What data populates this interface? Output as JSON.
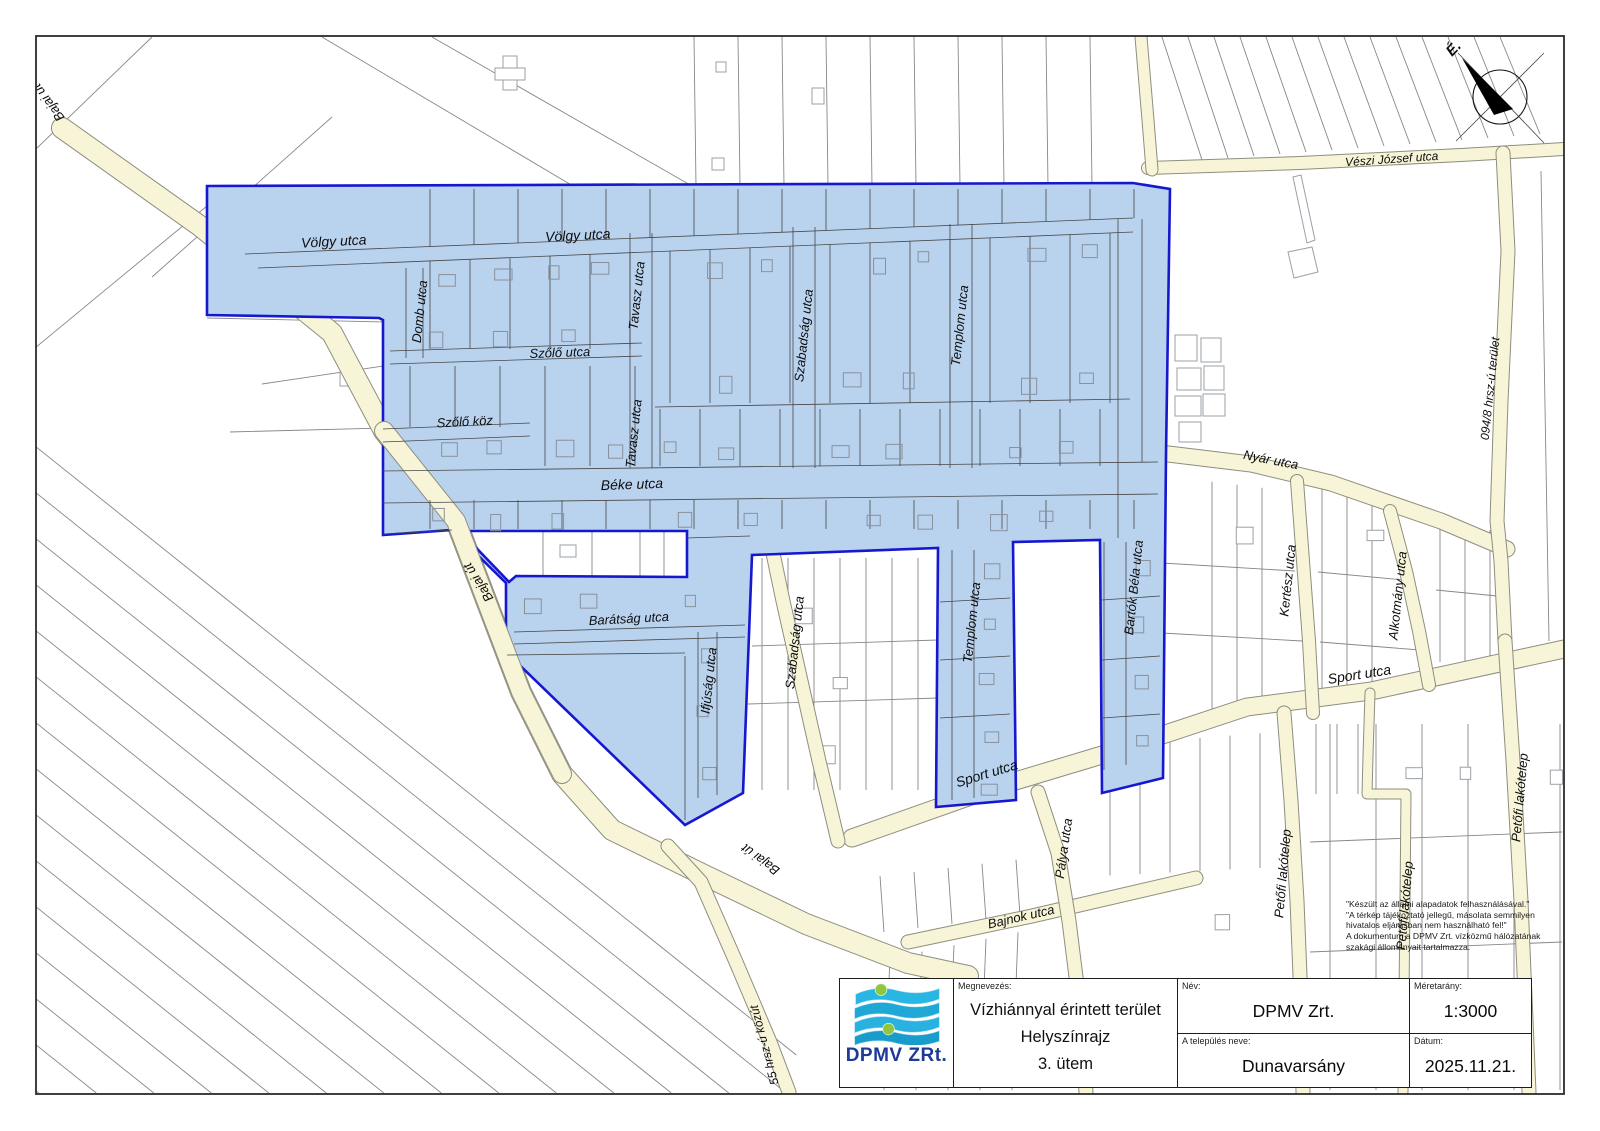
{
  "title_block": {
    "megnevezes_label": "Megnevezés:",
    "megnevezes_lines": [
      "Vízhiánnyal érintett terület",
      "Helyszínrajz",
      "3. ütem"
    ],
    "nev_label": "Név:",
    "nev_value": "DPMV Zrt.",
    "telepules_label": "A település neve:",
    "telepules_value": "Dunavarsány",
    "meretarany_label": "Méretarány:",
    "meretarany_value": "1:3000",
    "datum_label": "Dátum:",
    "datum_value": "2025.11.21.",
    "logo_text": "DPMV ZRt."
  },
  "disclaimer": {
    "lines": [
      "\"Készült az állami alapadatok felhasználásával.\"",
      "\"A térkép tájékoztató jellegű, másolata semmilyen",
      "hivatalos eljárásban nem használható fel!\"",
      "A dokumentum a DPMV Zrt. vízközmű hálózatának",
      "szakági állományait tartalmazza."
    ]
  },
  "compass": {
    "cx": 1500,
    "cy": 97,
    "r": 27,
    "label": "É."
  },
  "map": {
    "colors": {
      "highlight_fill": "#b9d3ef",
      "highlight_stroke": "#1717cf",
      "road_fill": "#f7f4d8",
      "road_edge": "#8e8e7e",
      "parcel_line": "#878787",
      "inner_line": "#474747"
    },
    "highlight_outline": [
      [
        207,
        186
      ],
      [
        1133,
        183
      ],
      [
        1170,
        189
      ],
      [
        1166,
        455
      ],
      [
        1163,
        778
      ],
      [
        1102,
        793
      ],
      [
        1100,
        540
      ],
      [
        1013,
        542
      ],
      [
        1016,
        800
      ],
      [
        936,
        807
      ],
      [
        938,
        548
      ],
      [
        752,
        555
      ],
      [
        743,
        793
      ],
      [
        685,
        825
      ],
      [
        506,
        652
      ],
      [
        506,
        583
      ],
      [
        452,
        530
      ],
      [
        383,
        535
      ],
      [
        383,
        320
      ],
      [
        379,
        318
      ],
      [
        207,
        315
      ]
    ],
    "highlight_hole": [
      [
        460,
        531
      ],
      [
        687,
        531
      ],
      [
        687,
        577
      ],
      [
        516,
        576
      ],
      [
        509,
        582
      ]
    ],
    "roads": [
      {
        "pts": [
          [
            62,
            128
          ],
          [
            200,
            226
          ],
          [
            332,
            333
          ],
          [
            384,
            431
          ],
          [
            456,
            521
          ],
          [
            521,
            692
          ],
          [
            562,
            774
          ],
          [
            612,
            830
          ],
          [
            702,
            874
          ],
          [
            806,
            924
          ],
          [
            908,
            963
          ],
          [
            968,
            976
          ]
        ],
        "w": 20
      },
      {
        "pts": [
          [
            668,
            846
          ],
          [
            701,
            882
          ],
          [
            736,
            962
          ],
          [
            770,
            1042
          ],
          [
            789,
            1092
          ]
        ],
        "w": 13
      },
      {
        "pts": [
          [
            852,
            838
          ],
          [
            1002,
            785
          ],
          [
            1102,
            755
          ],
          [
            1247,
            707
          ],
          [
            1371,
            691
          ],
          [
            1564,
            649
          ]
        ],
        "w": 17
      },
      {
        "pts": [
          [
            908,
            942
          ],
          [
            1032,
            916
          ],
          [
            1196,
            878
          ]
        ],
        "w": 13
      },
      {
        "pts": [
          [
            1038,
            792
          ],
          [
            1058,
            853
          ],
          [
            1069,
            921
          ],
          [
            1079,
            1001
          ],
          [
            1086,
            1092
          ]
        ],
        "w": 13
      },
      {
        "pts": [
          [
            1160,
            453
          ],
          [
            1251,
            464
          ],
          [
            1331,
            483
          ],
          [
            1441,
            521
          ],
          [
            1507,
            549
          ]
        ],
        "w": 15
      },
      {
        "pts": [
          [
            1297,
            481
          ],
          [
            1303,
            561
          ],
          [
            1309,
            641
          ],
          [
            1313,
            713
          ]
        ],
        "w": 12
      },
      {
        "pts": [
          [
            1390,
            511
          ],
          [
            1406,
            571
          ],
          [
            1419,
            631
          ],
          [
            1429,
            685
          ]
        ],
        "w": 12
      },
      {
        "pts": [
          [
            1148,
            168
          ],
          [
            1300,
            163
          ],
          [
            1461,
            155
          ],
          [
            1564,
            149
          ]
        ],
        "w": 12
      },
      {
        "pts": [
          [
            1141,
            37
          ],
          [
            1148,
            120
          ],
          [
            1152,
            170
          ]
        ],
        "w": 11
      },
      {
        "pts": [
          [
            1503,
            153
          ],
          [
            1508,
            251
          ],
          [
            1501,
            401
          ],
          [
            1497,
            521
          ],
          [
            1501,
            561
          ],
          [
            1505,
            641
          ]
        ],
        "w": 13
      },
      {
        "pts": [
          [
            1284,
            713
          ],
          [
            1291,
            801
          ],
          [
            1297,
            901
          ],
          [
            1301,
            1001
          ],
          [
            1303,
            1092
          ]
        ],
        "w": 13
      },
      {
        "pts": [
          [
            1370,
            693
          ],
          [
            1368,
            756
          ],
          [
            1367,
            794
          ],
          [
            1406,
            794
          ],
          [
            1405,
            901
          ],
          [
            1403,
            1092
          ]
        ],
        "w": 9
      },
      {
        "pts": [
          [
            1505,
            641
          ],
          [
            1513,
            761
          ],
          [
            1521,
            901
          ],
          [
            1529,
            1092
          ]
        ],
        "w": 13
      },
      {
        "pts": [
          [
            770,
            539
          ],
          [
            783,
            601
          ],
          [
            801,
            681
          ],
          [
            819,
            761
          ],
          [
            838,
            841
          ]
        ],
        "w": 13
      }
    ],
    "roads_overlay": [
      {
        "pts": [
          [
            384,
            431
          ],
          [
            456,
            521
          ],
          [
            521,
            692
          ],
          [
            562,
            774
          ]
        ],
        "w": 18
      }
    ],
    "inner_lines": [
      [
        245,
        254,
        1133,
        218
      ],
      [
        258,
        268,
        1133,
        232
      ],
      [
        390,
        351,
        642,
        343
      ],
      [
        390,
        364,
        642,
        356
      ],
      [
        383,
        429,
        530,
        423
      ],
      [
        383,
        442,
        530,
        436
      ],
      [
        383,
        471,
        1158,
        462
      ],
      [
        383,
        503,
        1158,
        494
      ],
      [
        406,
        268,
        406,
        358
      ],
      [
        423,
        268,
        423,
        358
      ],
      [
        630,
        233,
        630,
        468
      ],
      [
        652,
        233,
        652,
        468
      ],
      [
        793,
        227,
        793,
        468
      ],
      [
        815,
        227,
        815,
        468
      ],
      [
        950,
        224,
        950,
        468
      ],
      [
        972,
        224,
        972,
        468
      ],
      [
        1118,
        219,
        1118,
        538
      ],
      [
        1142,
        219,
        1142,
        462
      ],
      [
        655,
        407,
        1130,
        399
      ],
      [
        383,
        534,
        452,
        530
      ],
      [
        687,
        538,
        750,
        536
      ],
      [
        514,
        632,
        745,
        625
      ],
      [
        514,
        644,
        745,
        637
      ],
      [
        507,
        655,
        685,
        653
      ],
      [
        685,
        656,
        685,
        820
      ],
      [
        698,
        632,
        698,
        798
      ],
      [
        717,
        632,
        717,
        795
      ],
      [
        952,
        550,
        952,
        800
      ],
      [
        974,
        550,
        974,
        798
      ],
      [
        1104,
        542,
        1104,
        770
      ],
      [
        1126,
        542,
        1126,
        765
      ],
      [
        940,
        602,
        1010,
        598
      ],
      [
        940,
        660,
        1010,
        656
      ],
      [
        940,
        718,
        1010,
        714
      ],
      [
        1102,
        600,
        1160,
        596
      ],
      [
        1102,
        660,
        1160,
        656
      ],
      [
        1102,
        718,
        1160,
        714
      ]
    ],
    "street_labels": [
      {
        "t": "Völgy utca",
        "x": 334,
        "y": 246,
        "r": -3,
        "s": 14
      },
      {
        "t": "Völgy utca",
        "x": 578,
        "y": 240,
        "r": -3,
        "s": 14
      },
      {
        "t": "Domb utca",
        "x": 424,
        "y": 312,
        "r": -84,
        "s": 13
      },
      {
        "t": "Tavasz utca",
        "x": 641,
        "y": 296,
        "r": -84,
        "s": 13
      },
      {
        "t": "Szőlő utca",
        "x": 560,
        "y": 357,
        "r": -2,
        "s": 13
      },
      {
        "t": "Szőlő köz",
        "x": 465,
        "y": 426,
        "r": -3,
        "s": 13
      },
      {
        "t": "Tavasz utca",
        "x": 638,
        "y": 434,
        "r": -84,
        "s": 13
      },
      {
        "t": "Szabadság utca",
        "x": 808,
        "y": 336,
        "r": -84,
        "s": 13
      },
      {
        "t": "Templom utca",
        "x": 964,
        "y": 326,
        "r": -84,
        "s": 13
      },
      {
        "t": "Béke utca",
        "x": 632,
        "y": 489,
        "r": -2,
        "s": 14
      },
      {
        "t": "Barátság utca",
        "x": 629,
        "y": 623,
        "r": -3,
        "s": 13
      },
      {
        "t": "Ifjúság utca",
        "x": 713,
        "y": 681,
        "r": -84,
        "s": 13
      },
      {
        "t": "Szabadság utca",
        "x": 799,
        "y": 643,
        "r": -84,
        "s": 13
      },
      {
        "t": "Templom utca",
        "x": 976,
        "y": 623,
        "r": -84,
        "s": 13
      },
      {
        "t": "Bartók Béla utca",
        "x": 1138,
        "y": 588,
        "r": -84,
        "s": 13
      },
      {
        "t": "Bajai út",
        "x": 482,
        "y": 580,
        "r": -123,
        "s": 13
      },
      {
        "t": "Bajai út",
        "x": 763,
        "y": 856,
        "r": -144,
        "s": 13
      },
      {
        "t": "Bajai út",
        "x": 52,
        "y": 100,
        "r": -127,
        "s": 13
      },
      {
        "t": "Sport utca",
        "x": 988,
        "y": 778,
        "r": -17,
        "s": 14
      },
      {
        "t": "Sport utca",
        "x": 1360,
        "y": 679,
        "r": -9,
        "s": 14
      },
      {
        "t": "Bajnok utca",
        "x": 1022,
        "y": 921,
        "r": -13,
        "s": 13
      },
      {
        "t": "Pálya utca",
        "x": 1068,
        "y": 849,
        "r": -82,
        "s": 13
      },
      {
        "t": "Nyár utca",
        "x": 1270,
        "y": 464,
        "r": 11,
        "s": 13
      },
      {
        "t": "Kertész utca",
        "x": 1292,
        "y": 581,
        "r": -84,
        "s": 13
      },
      {
        "t": "Alkotmány utca",
        "x": 1402,
        "y": 596,
        "r": -84,
        "s": 13
      },
      {
        "t": "Vészi József utca",
        "x": 1392,
        "y": 163,
        "r": -4,
        "s": 12
      },
      {
        "t": "094/8 hrsz-ú terület",
        "x": 1494,
        "y": 389,
        "r": -84,
        "s": 12
      },
      {
        "t": "Petőfi lakótelep",
        "x": 1287,
        "y": 874,
        "r": -85,
        "s": 13
      },
      {
        "t": "Petőfi lakótelep",
        "x": 1409,
        "y": 906,
        "r": -85,
        "s": 13
      },
      {
        "t": "Petőfi lakótelep",
        "x": 1524,
        "y": 798,
        "r": -85,
        "s": 13
      },
      {
        "t": "55 hrsz-ú közút",
        "x": 768,
        "y": 1044,
        "r": -105,
        "s": 12
      }
    ]
  }
}
